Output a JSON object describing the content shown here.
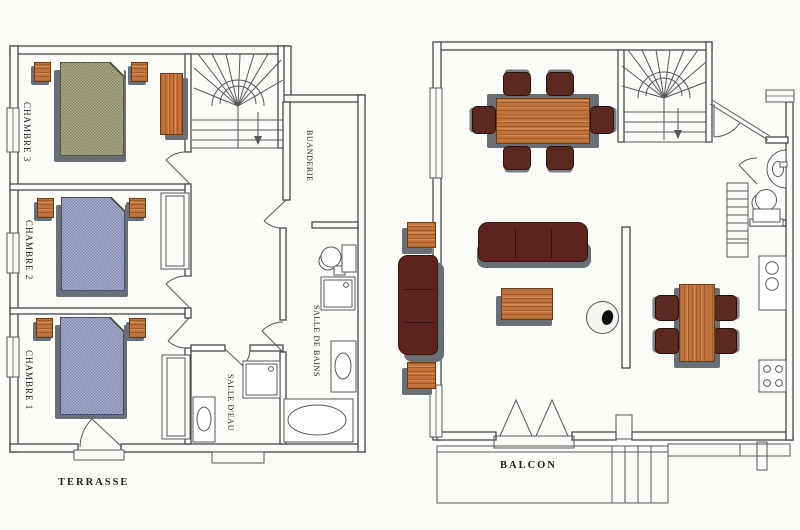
{
  "labels": {
    "chambre3": "CHAMBRE 3",
    "chambre2": "CHAMBRE 2",
    "chambre1": "CHAMBRE 1",
    "buanderie": "BUANDERIE",
    "salle_de_bains": "SALLE DE BAINS",
    "salle_d_eau": "SALLE D'EAU",
    "terrasse": "TERRASSE",
    "balcon": "BALCON"
  },
  "colors": {
    "paper": "#fbfbf8",
    "wall-line": "#46494d",
    "line": "#55585b",
    "shadow": "#6a6f77",
    "wood": "#c3733a",
    "wood-edge": "#6e3c12",
    "bed-green": "#8e8e66",
    "bed-blue": "#8991b7",
    "sofa": "#5e231c",
    "sofa-edge": "#3a120c",
    "chair": "#5b2920",
    "teal": "#a8ddd9",
    "text": "#1f1f1f"
  },
  "floors": {
    "upper_floor": {
      "rooms": [
        "CHAMBRE 3",
        "CHAMBRE 2",
        "CHAMBRE 1",
        "BUANDERIE",
        "SALLE DE BAINS",
        "SALLE D'EAU"
      ],
      "outdoor": "TERRASSE",
      "objects": [
        "double-bed",
        "double-bed",
        "double-bed",
        "nightstand",
        "nightstand",
        "nightstand",
        "nightstand",
        "nightstand",
        "nightstand",
        "wooden-wardrobe",
        "closet",
        "closet",
        "fan-staircase",
        "toilet",
        "shower",
        "shower",
        "washbasin",
        "washbasin",
        "bathtub",
        "terrace-step",
        "terrace-step"
      ]
    },
    "main_floor": {
      "outdoor": "BALCON",
      "objects": [
        "dining-table-6-chairs",
        "sofa-3-seat",
        "sofa-2-seat",
        "coffee-table",
        "side-table",
        "side-table",
        "wood-stove",
        "dining-table-4-chairs",
        "kitchen-counter",
        "kitchen-sink",
        "cooktop",
        "toilet",
        "corner-washbasin",
        "fan-staircase",
        "straight-staircase",
        "french-door",
        "balcony-stairs",
        "partition-wall"
      ]
    }
  }
}
